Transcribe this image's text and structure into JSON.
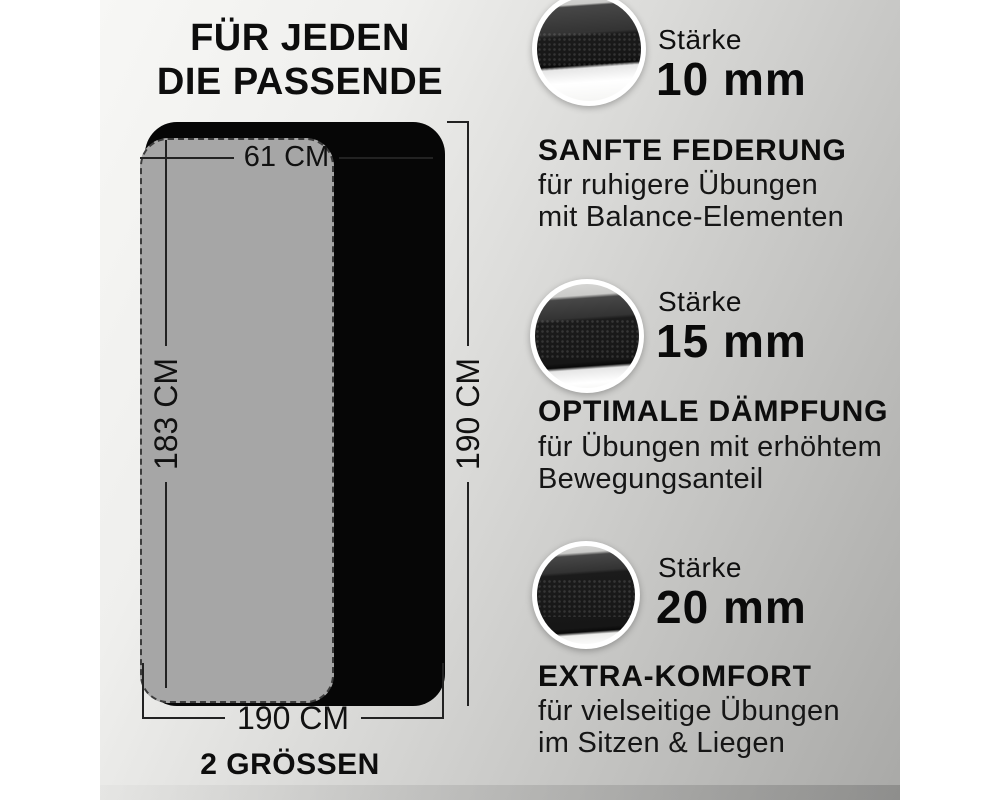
{
  "title": {
    "line1": "FÜR JEDEN",
    "line2": "DIE PASSENDE"
  },
  "diagram": {
    "small_mat_width": "61 CM",
    "small_mat_length": "183 CM",
    "large_mat_length": "190 CM",
    "large_mat_width": "190 CM",
    "caption": "2 GRÖSSEN"
  },
  "features": [
    {
      "thickness_label": "Stärke",
      "thickness_value": "10 mm",
      "heading": "SANFTE FEDERUNG",
      "line1": "für ruhigere Übungen",
      "line2": "mit Balance-Elementen"
    },
    {
      "thickness_label": "Stärke",
      "thickness_value": "15 mm",
      "heading": "OPTIMALE DÄMPFUNG",
      "line1": "für Übungen mit erhöhtem",
      "line2": "Bewegungsanteil"
    },
    {
      "thickness_label": "Stärke",
      "thickness_value": "20 mm",
      "heading": "EXTRA-KOMFORT",
      "line1": "für vielseitige Übungen",
      "line2": "im Sitzen & Liegen"
    }
  ],
  "colors": {
    "large_mat": "#060606",
    "small_mat": "#a6a6a6",
    "text": "#0d0d0d",
    "background_light": "#f7f7f5",
    "background_dark": "#a9a9a7"
  }
}
